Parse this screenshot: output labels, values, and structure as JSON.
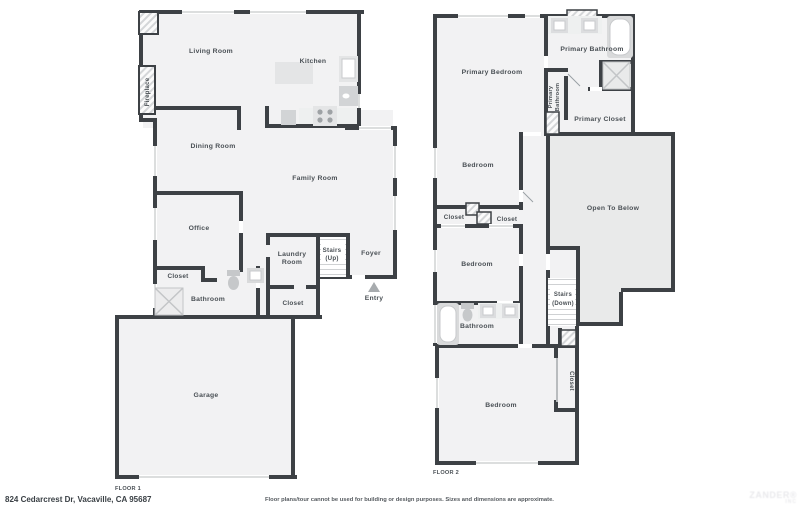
{
  "address": "824 Cedarcrest Dr, Vacaville, CA 95687",
  "footer": {
    "disclaimer": "Floor plans/tour cannot be used for building or design purposes. Sizes and dimensions are approximate.",
    "floor1_label": "FLOOR 1",
    "floor2_label": "FLOOR 2"
  },
  "watermark": {
    "line1": "ZANDER®",
    "line2": "INC"
  },
  "colors": {
    "wall": "#3d4145",
    "room_fill": "#f2f2f3",
    "open_to_below_fill": "#e9eaea",
    "label_text": "#4a5055",
    "window_line": "#b9bcbe",
    "fixture_gray": "#d9dadb"
  },
  "floor1": {
    "living_room": "Living Room",
    "kitchen": "Kitchen",
    "fireplace": "Fireplace",
    "dining_room": "Dining Room",
    "family_room": "Family Room",
    "office": "Office",
    "closet": "Closet",
    "bathroom": "Bathroom",
    "laundry_line1": "Laundry",
    "laundry_line2": "Room",
    "stairs_line1": "Stairs",
    "stairs_line2": "(Up)",
    "foyer": "Foyer",
    "entry": "Entry",
    "closet2": "Closet",
    "garage": "Garage"
  },
  "floor2": {
    "primary_bedroom": "Primary Bedroom",
    "primary_bathroom": "Primary Bathroom",
    "primary_bathroom_small_line1": "Primary",
    "primary_bathroom_small_line2": "Bathroom",
    "primary_closet": "Primary Closet",
    "bedroom1": "Bedroom",
    "closet_left": "Closet",
    "closet_right": "Closet",
    "open_to_below": "Open To Below",
    "bedroom2": "Bedroom",
    "stairs_line1": "Stairs",
    "stairs_line2": "(Down)",
    "bathroom": "Bathroom",
    "bedroom3": "Bedroom",
    "closet_vertical": "Closet"
  }
}
